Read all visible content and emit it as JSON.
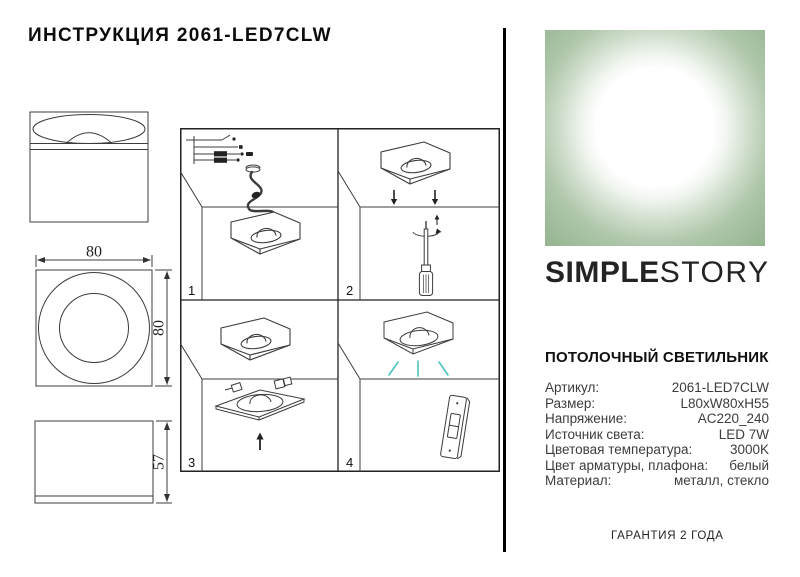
{
  "page": {
    "title": "ИНСТРУКЦИЯ 2061-LED7CLW",
    "warranty": "ГАРАНТИЯ 2 ГОДА"
  },
  "brand": {
    "word1": "SIMPLE",
    "word2": "STORY"
  },
  "product": {
    "heading": "ПОТОЛОЧНЫЙ СВЕТИЛЬНИК",
    "specs": [
      {
        "label": "Артикул:",
        "value": "2061-LED7CLW"
      },
      {
        "label": "Размер:",
        "value": "L80xW80xH55"
      },
      {
        "label": "Напряжение:",
        "value": "AC220_240"
      },
      {
        "label": "Источник света:",
        "value": "LED 7W"
      },
      {
        "label": "Цветовая температура:",
        "value": "3000K"
      },
      {
        "label": "Цвет арматуры, плафона:",
        "value": "белый"
      },
      {
        "label": "Материал:",
        "value": "металл, стекло"
      }
    ]
  },
  "dimensions": {
    "width": "80",
    "height": "80",
    "depth": "57"
  },
  "steps": [
    {
      "number": "1"
    },
    {
      "number": "2"
    },
    {
      "number": "3"
    },
    {
      "number": "4"
    }
  ],
  "colors": {
    "brand_green": "#a8c2a4",
    "light_ray_teal": "#4cc3c3",
    "drawing_line": "#3c3c3c"
  }
}
